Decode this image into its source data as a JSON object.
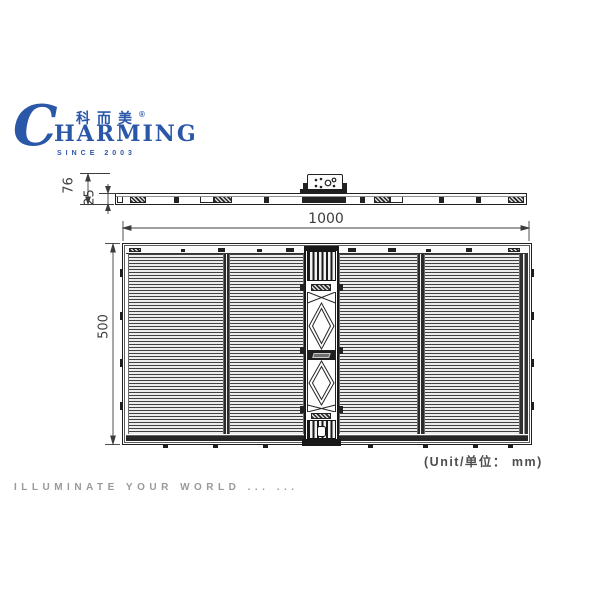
{
  "brand": {
    "initial": "C",
    "cn_name": "科而美",
    "registered_mark": "®",
    "latin_rest": "HARMING",
    "since_line": "SINCE 2003",
    "brand_color": "#2b57a8"
  },
  "side_view": {
    "depth_label": "76",
    "thickness_label": "25"
  },
  "front_view": {
    "width_label": "1000",
    "height_label": "500"
  },
  "notes": {
    "unit": "(Unit/单位： mm)"
  },
  "footer": {
    "tagline": "ILLUMINATE YOUR WORLD ... ..."
  },
  "colors": {
    "brand_blue": "#2b57a8",
    "drawing_line": "#2f2f2f",
    "muted_text": "#9a9a9a"
  }
}
